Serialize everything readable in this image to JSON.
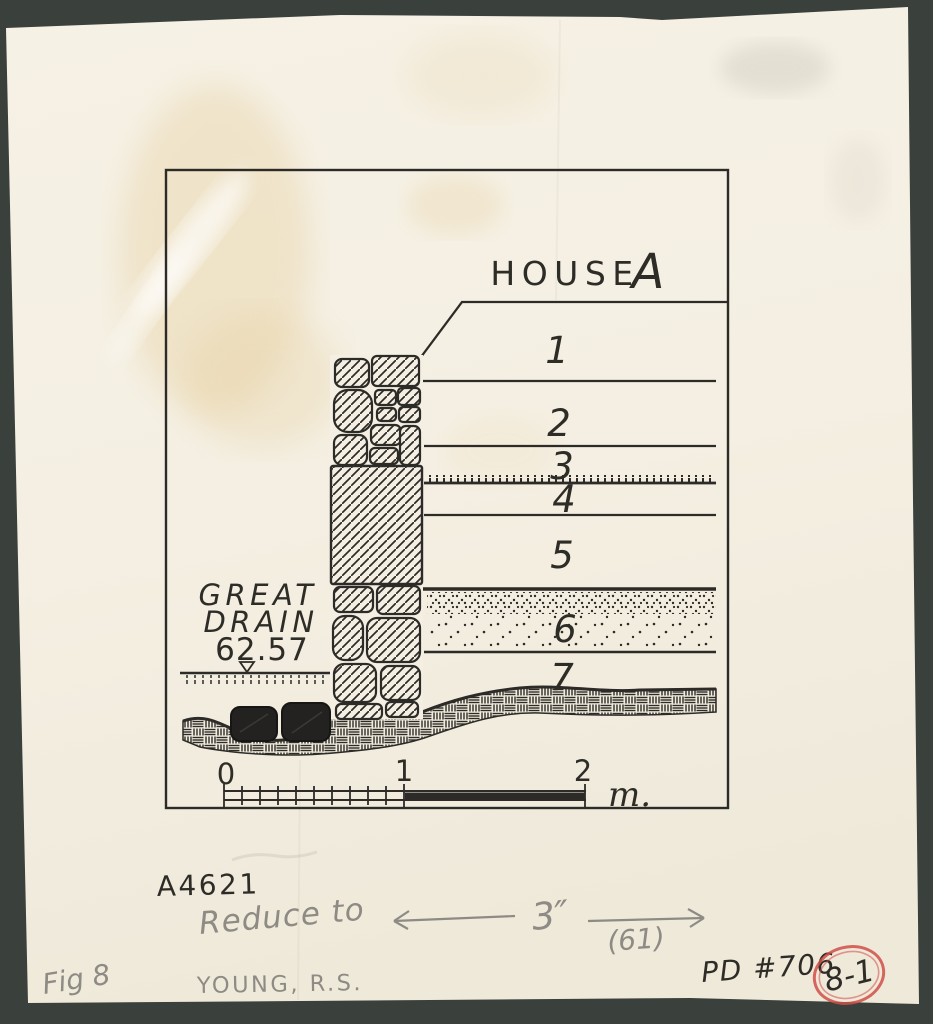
{
  "document": {
    "title_word": "HOUSE",
    "title_letter": "A",
    "layers": [
      "1",
      "2",
      "3",
      "4",
      "5",
      "6",
      "7"
    ],
    "drain": {
      "label_line1": "GREAT",
      "label_line2": "DRAIN",
      "elevation": "62.57"
    },
    "scale": {
      "zero": "0",
      "one": "1",
      "two": "2",
      "unit": "m."
    }
  },
  "annotations": {
    "negative_number": "A4621",
    "pencil_instruction": "Reduce to",
    "target_width": "3″",
    "pencil_note": "(61)",
    "figure_label": "Fig 8",
    "author": "YOUNG, R.S.",
    "pd_number": "PD #706",
    "red_stamp": "8-1"
  },
  "colors": {
    "ink": "#2e2c27",
    "pencil": "#8e8b84",
    "blue_pen": "#3c43a1",
    "red_stamp": "#cf4f48",
    "paper": "#f4efe2",
    "background": "#3a403c"
  }
}
